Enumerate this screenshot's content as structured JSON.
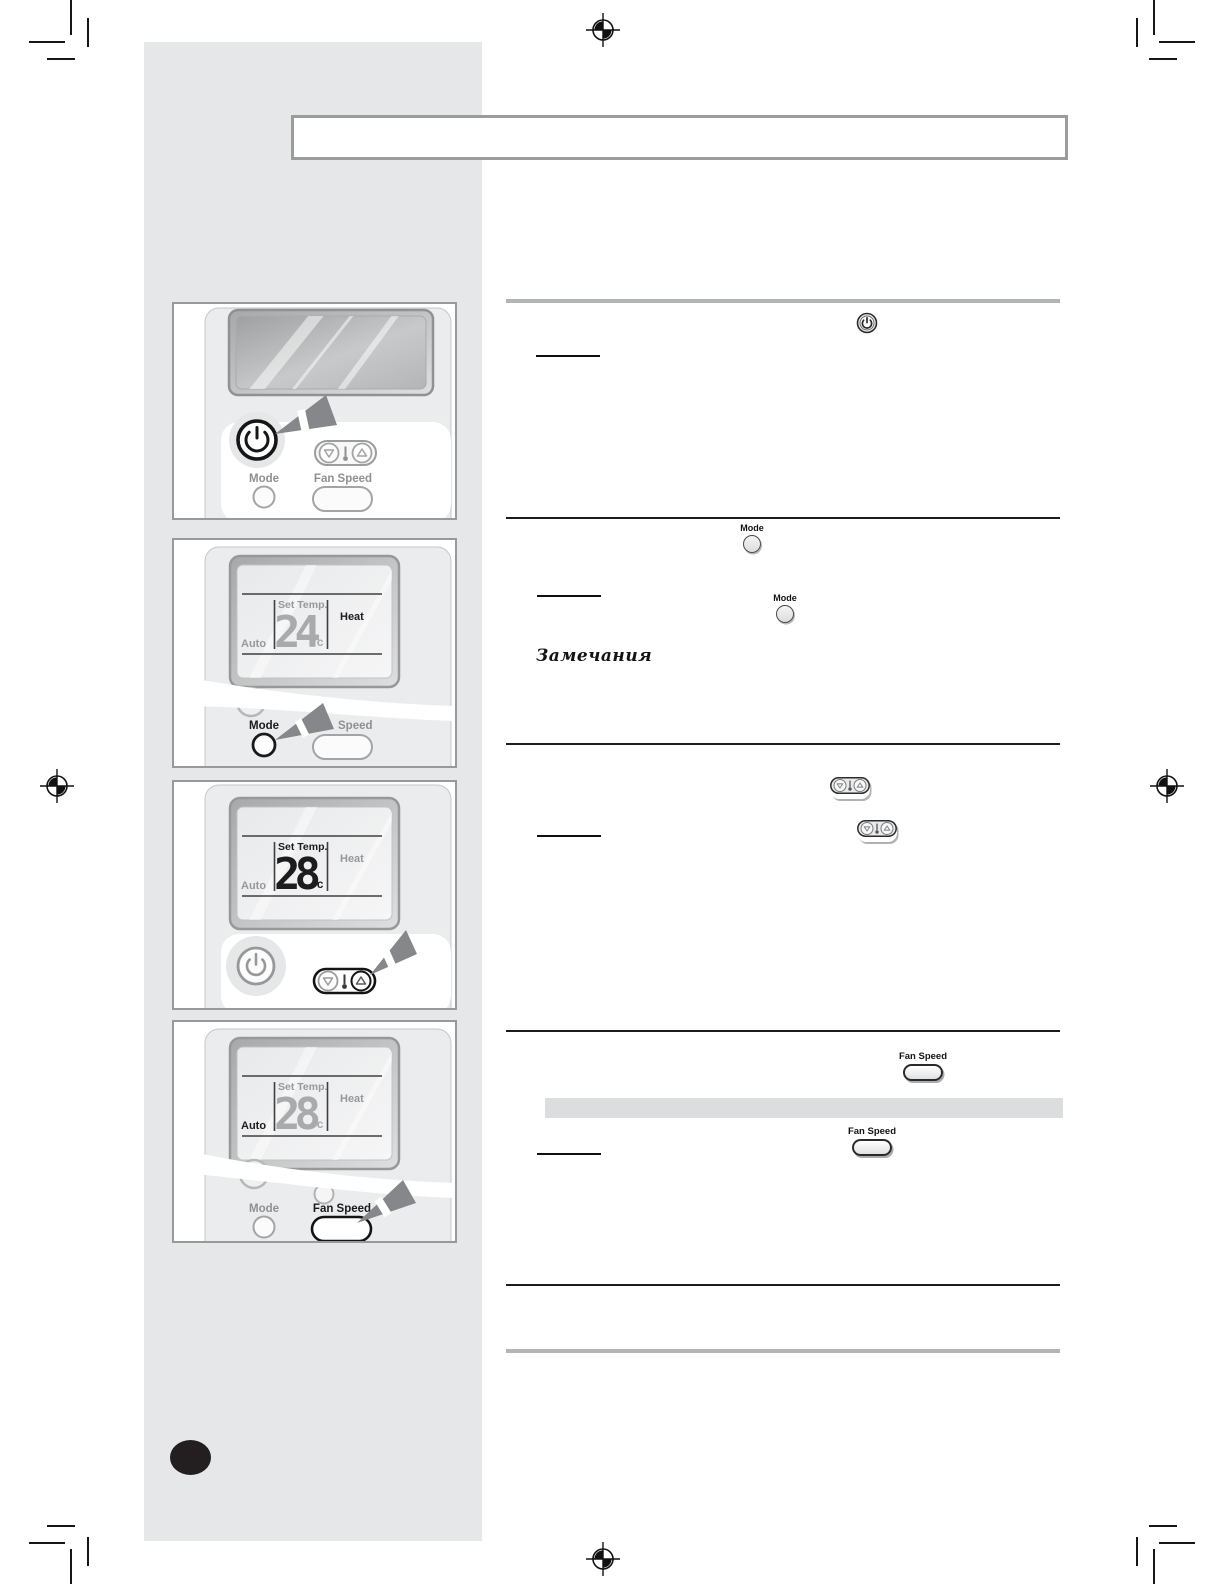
{
  "document": {
    "kind": "appliance-manual-page-scan",
    "notes_heading": "Замечания"
  },
  "labels": {
    "mode": "Mode",
    "fan_speed": "Fan Speed",
    "speed_partial": "Speed",
    "set_temp": "Set Temp.",
    "heat": "Heat",
    "auto": "Auto",
    "temp_unit": "°c",
    "temp_initial": "24",
    "temp_adjusted": "28"
  },
  "panels": {
    "panel_1_highlight": "power-button",
    "panel_2_highlight": "mode-button",
    "panel_3_highlight": "temp-up-button",
    "panel_4_highlight": "fan-speed-button"
  },
  "colors": {
    "sidebar_bg": "#e6e7e8",
    "panel_border": "#97999b",
    "divider_gray": "#b2b4b6",
    "divider_black": "#1c1c1e",
    "highlight_bar": "#dcdddf",
    "arrow_gray": "#85878a",
    "label_gray": "#8e9092",
    "label_black": "#1a1a1c",
    "lcd_digit_gray": "#a8aaac",
    "page_bubble": "#231f20"
  }
}
